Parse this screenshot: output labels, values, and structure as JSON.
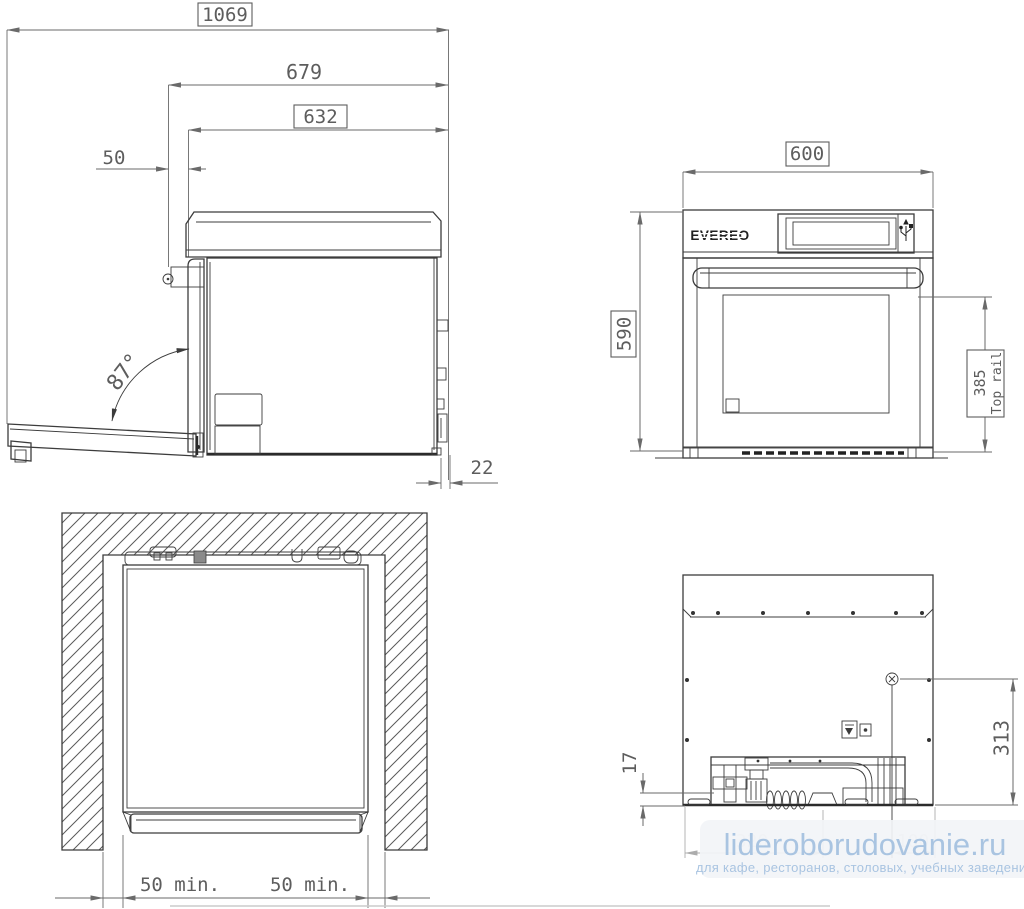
{
  "dimensions": {
    "total_width": "1069",
    "depth_door_open": "679",
    "depth_body": "632",
    "front_offset": "50",
    "door_angle": "87°",
    "rear_gap": "22",
    "front_width": "600",
    "front_height": "590",
    "top_rail_height": "385",
    "top_rail_label": "Top rail",
    "left_clearance": "50 min.",
    "right_clearance": "50 min.",
    "rear_bottom_offset": "17",
    "connection_height": "313",
    "obscured_left": "320",
    "obscured_right": "100"
  },
  "brand": {
    "logo_text": "EVEREO"
  },
  "watermark": {
    "site": "lideroborudovanie.ru",
    "tagline": "для кафе, ресторанов, столовых, учебных заведений",
    "text_color": "#a9c4e1",
    "bg_color": "#f2f4f7"
  },
  "colors": {
    "line": "#3c3c3c",
    "dimension": "#6a6a6a",
    "dim_text": "#5d5d5d"
  }
}
